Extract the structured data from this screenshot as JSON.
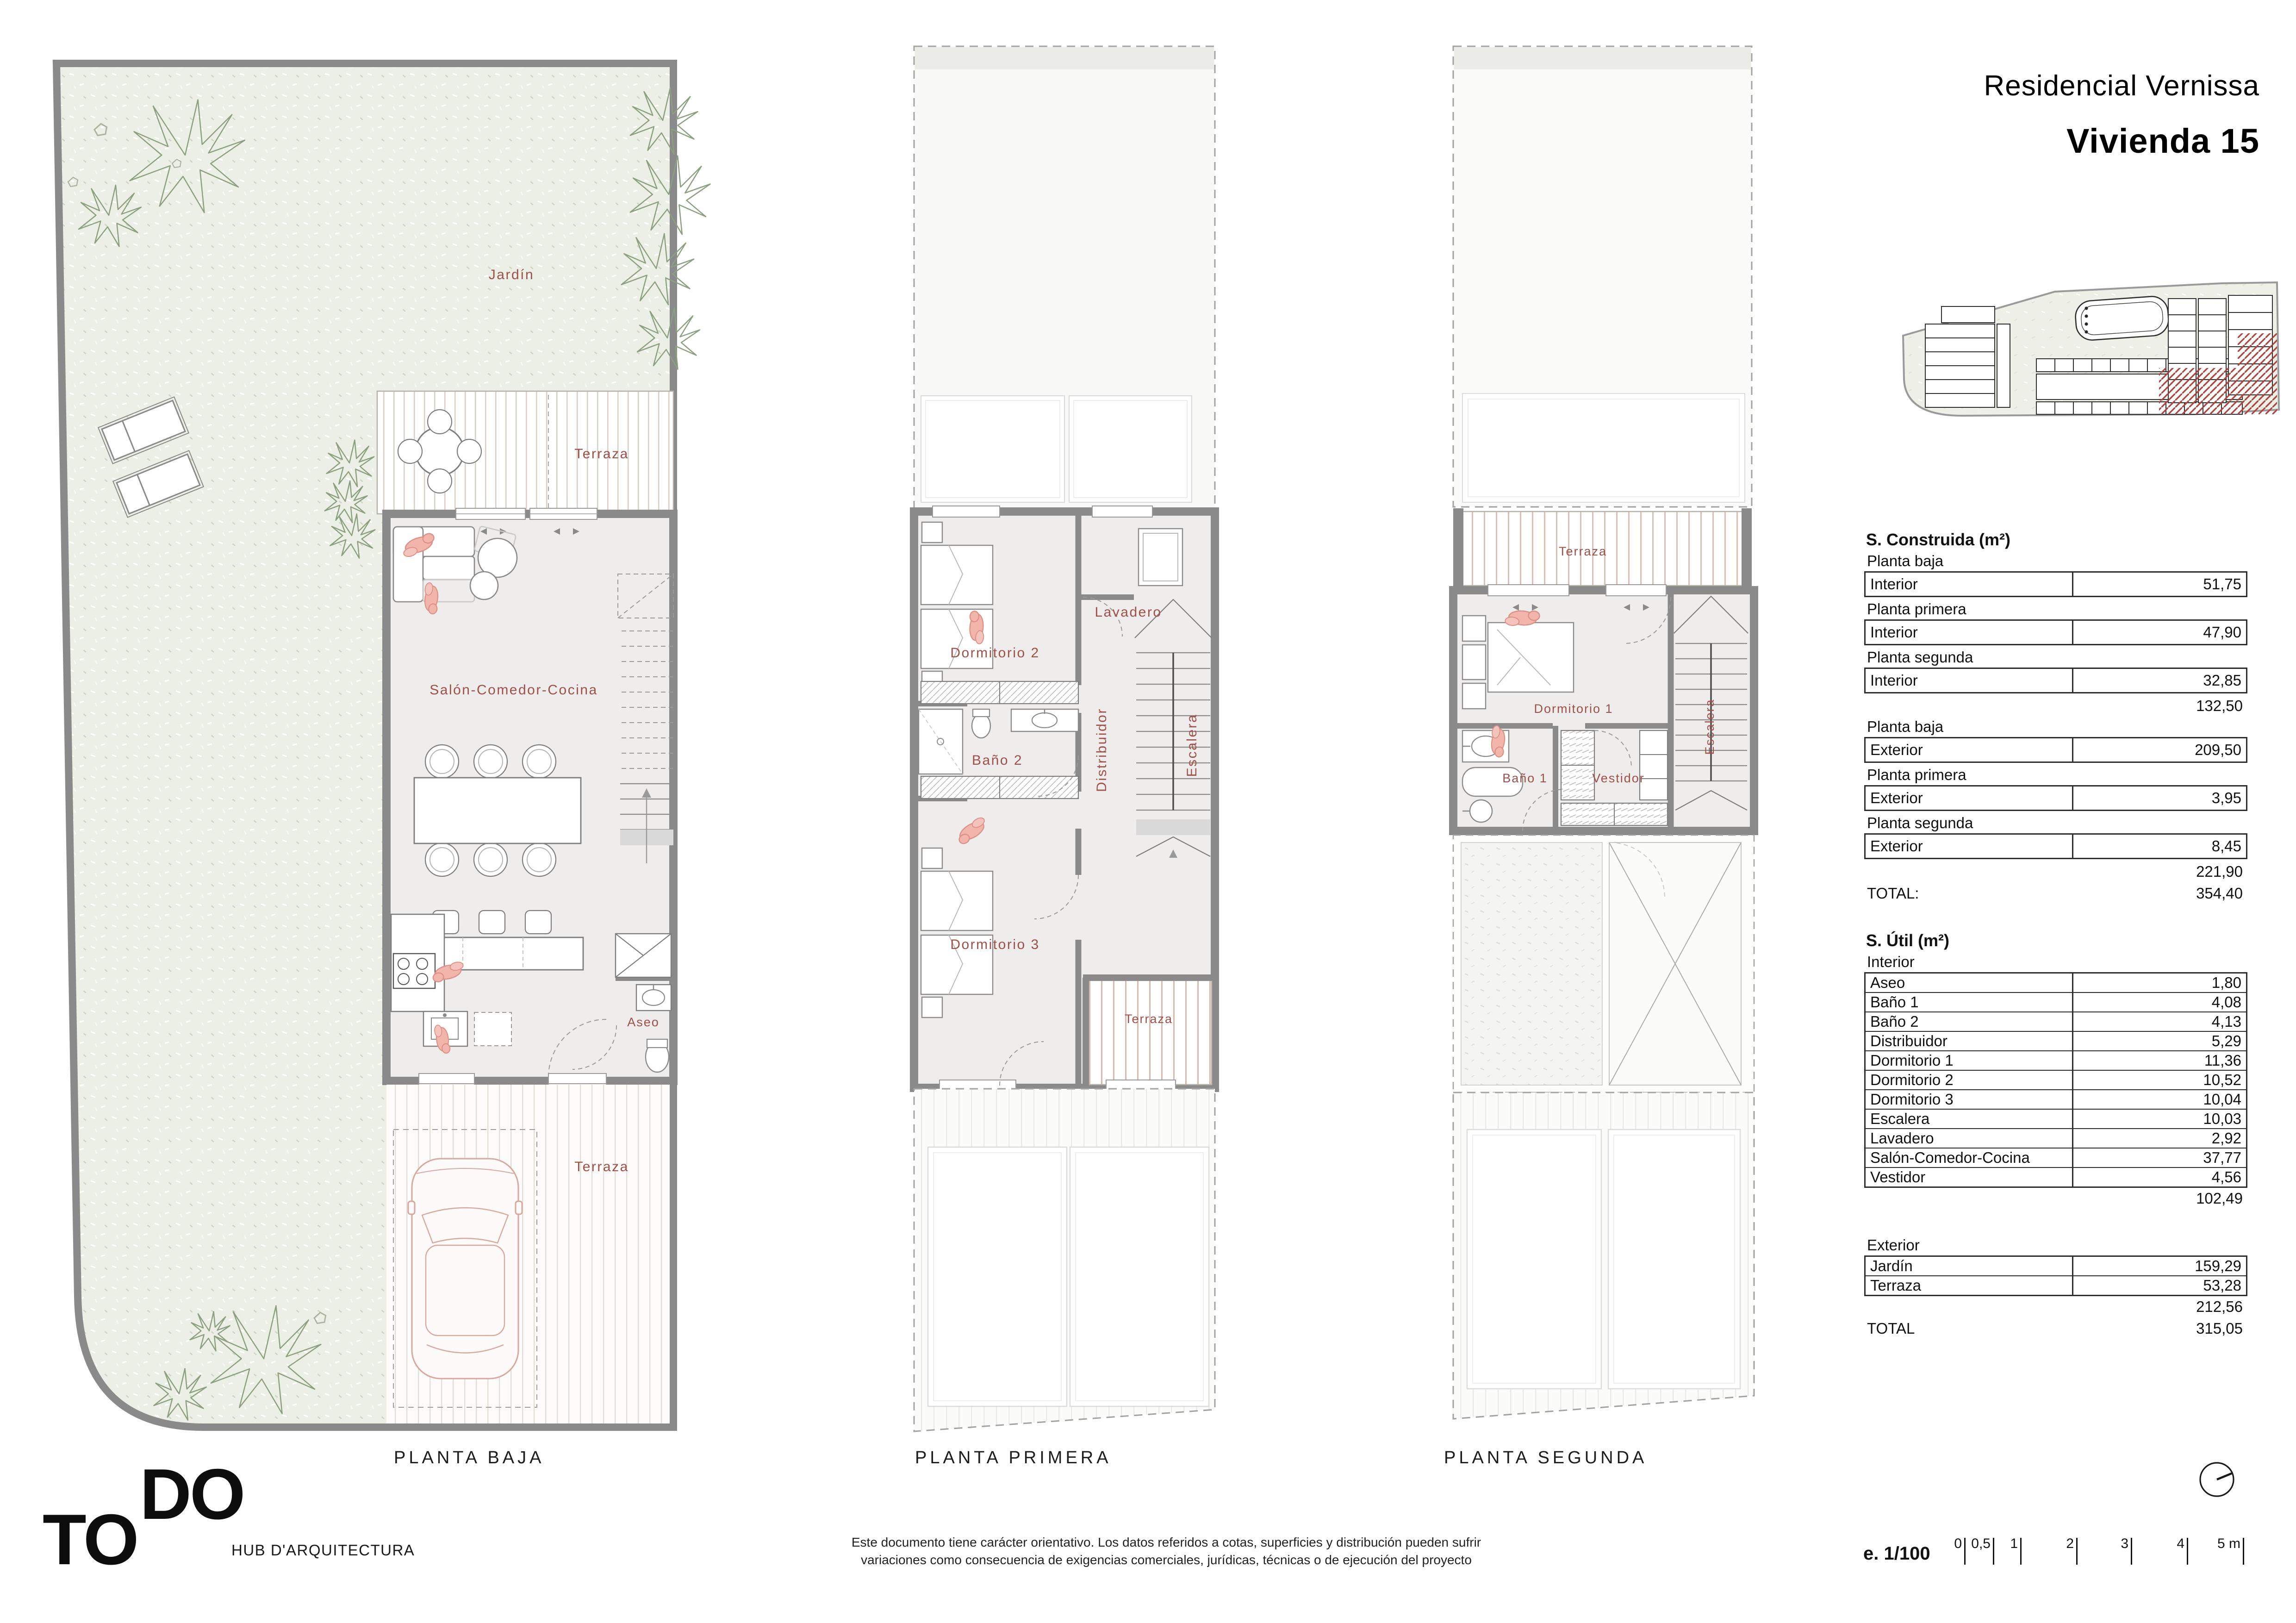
{
  "header": {
    "project": "Residencial Vernissa",
    "unit": "Vivienda 15"
  },
  "plans": [
    {
      "caption": "PLANTA BAJA",
      "labels": {
        "jardin": "Jardín",
        "terraza_top": "Terraza",
        "salon": "Salón-Comedor-Cocina",
        "aseo": "Aseo",
        "terraza_front": "Terraza"
      }
    },
    {
      "caption": "PLANTA PRIMERA",
      "labels": {
        "dormitorio2": "Dormitorio 2",
        "lavadero": "Lavadero",
        "distribuidor": "Distribuidor",
        "escalera": "Escalera",
        "bano2": "Baño 2",
        "dormitorio3": "Dormitorio 3",
        "terraza": "Terraza"
      }
    },
    {
      "caption": "PLANTA SEGUNDA",
      "labels": {
        "terraza": "Terraza",
        "dormitorio1": "Dormitorio 1",
        "bano1": "Baño 1",
        "vestidor": "Vestidor",
        "escalera": "Escalera"
      }
    }
  ],
  "surface_tables": {
    "construida": {
      "title": "S. Construida (m²)",
      "interior_sections": [
        {
          "heading": "Planta baja",
          "label": "Interior",
          "value": "51,75"
        },
        {
          "heading": "Planta primera",
          "label": "Interior",
          "value": "47,90"
        },
        {
          "heading": "Planta segunda",
          "label": "Interior",
          "value": "32,85"
        }
      ],
      "interior_subtotal": "132,50",
      "exterior_sections": [
        {
          "heading": "Planta baja",
          "label": "Exterior",
          "value": "209,50"
        },
        {
          "heading": "Planta primera",
          "label": "Exterior",
          "value": "3,95"
        },
        {
          "heading": "Planta segunda",
          "label": "Exterior",
          "value": "8,45"
        }
      ],
      "exterior_subtotal": "221,90",
      "total_label": "TOTAL:",
      "total_value": "354,40"
    },
    "util": {
      "title": "S. Útil (m²)",
      "interior_heading": "Interior",
      "interior_rows": [
        {
          "label": "Aseo",
          "value": "1,80"
        },
        {
          "label": "Baño 1",
          "value": "4,08"
        },
        {
          "label": "Baño 2",
          "value": "4,13"
        },
        {
          "label": "Distribuidor",
          "value": "5,29"
        },
        {
          "label": "Dormitorio 1",
          "value": "11,36"
        },
        {
          "label": "Dormitorio 2",
          "value": "10,52"
        },
        {
          "label": "Dormitorio 3",
          "value": "10,04"
        },
        {
          "label": "Escalera",
          "value": "10,03"
        },
        {
          "label": "Lavadero",
          "value": "2,92"
        },
        {
          "label": "Salón-Comedor-Cocina",
          "value": "37,77"
        },
        {
          "label": "Vestidor",
          "value": "4,56"
        }
      ],
      "interior_subtotal": "102,49",
      "exterior_heading": "Exterior",
      "exterior_rows": [
        {
          "label": "Jardín",
          "value": "159,29"
        },
        {
          "label": "Terraza",
          "value": "53,28"
        }
      ],
      "exterior_subtotal": "212,56",
      "total_label": "TOTAL",
      "total_value": "315,05"
    }
  },
  "footer": {
    "logo_do": "DO",
    "logo_to": "TO",
    "firm": "HUB D'ARQUITECTURA",
    "disclaimer_line1": "Este documento tiene carácter orientativo. Los datos referidos a cotas, superficies y distribución pueden sufrir",
    "disclaimer_line2": "variaciones como consecuencia de exigencias comerciales, jurídicas, técnicas o de ejecución del proyecto",
    "scale_label": "e. 1/100",
    "scale_ticks": [
      "0",
      "0,5",
      "1",
      "2",
      "3",
      "4",
      "5 m"
    ]
  },
  "colors": {
    "accent_label": "#9e5049",
    "wall_gray": "#8a8a8a",
    "hatch_red": "#b5403a",
    "garden_fill": "#ecefe6"
  }
}
